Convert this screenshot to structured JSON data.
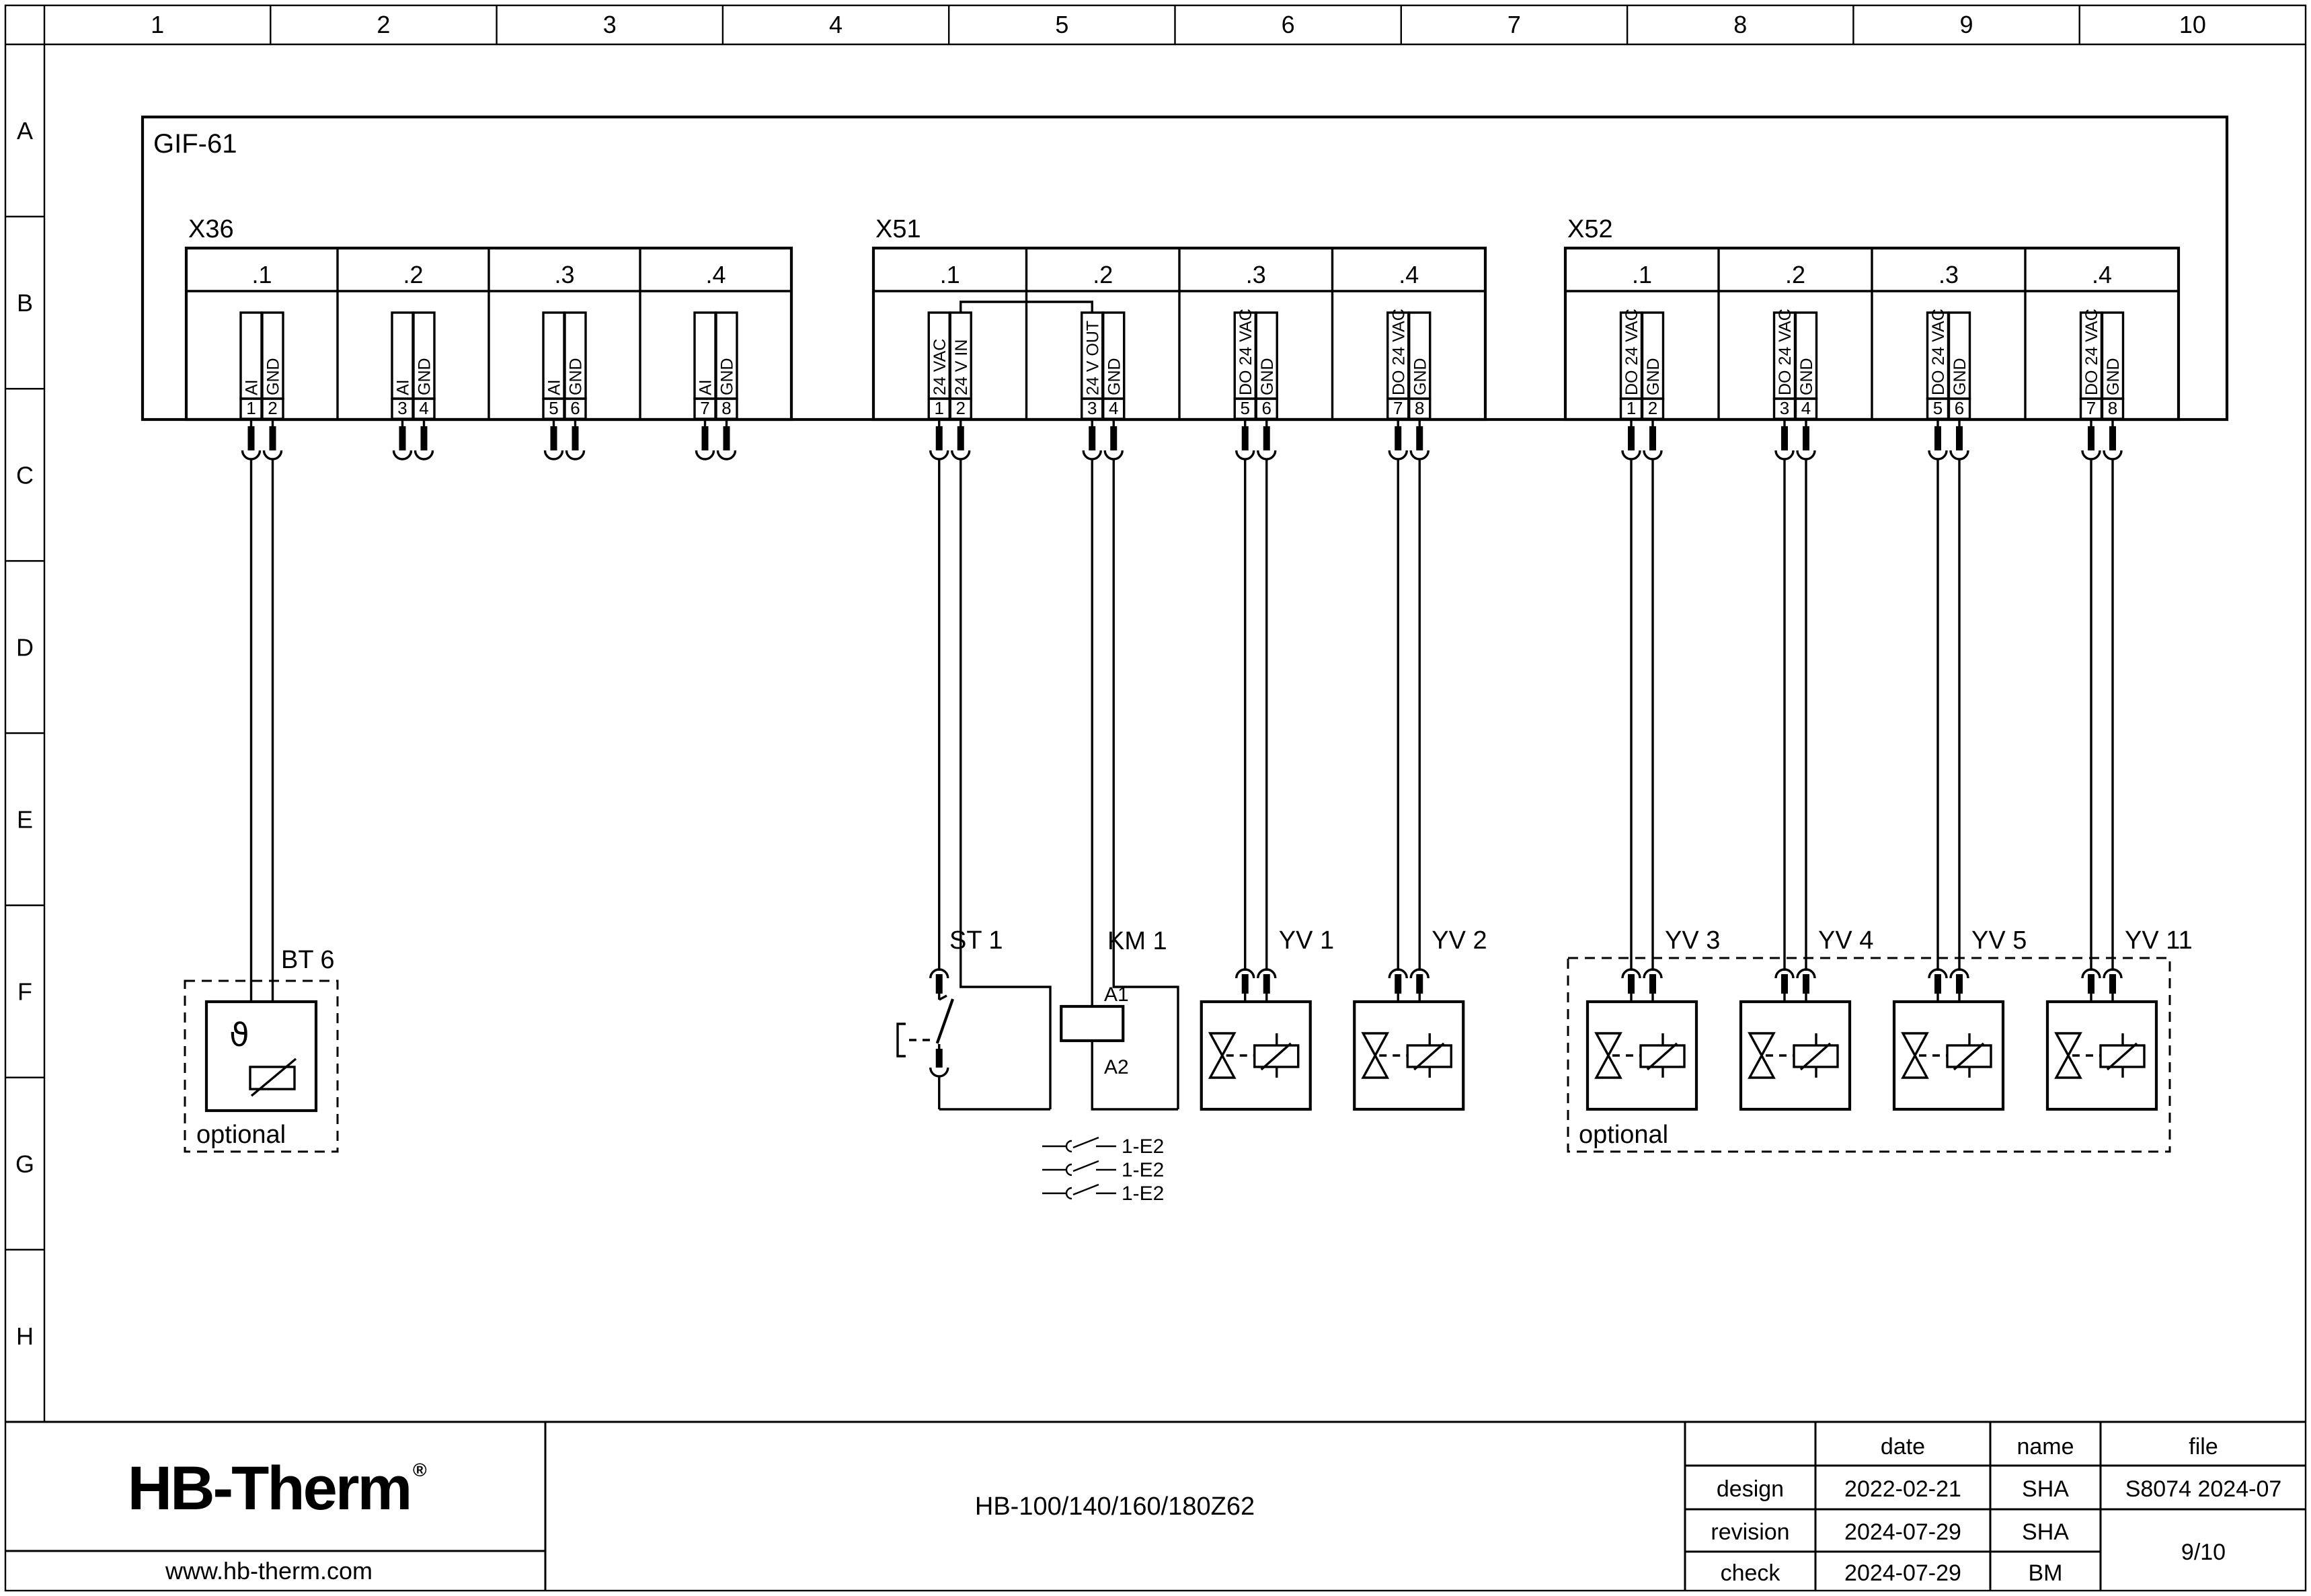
{
  "page": {
    "columns": [
      "1",
      "2",
      "3",
      "4",
      "5",
      "6",
      "7",
      "8",
      "9",
      "10"
    ],
    "rows": [
      "A",
      "B",
      "C",
      "D",
      "E",
      "F",
      "G",
      "H"
    ]
  },
  "module": {
    "label": "GIF-61"
  },
  "connectors": [
    {
      "label": "X36",
      "sections": [
        ".1",
        ".2",
        ".3",
        ".4"
      ],
      "pins": [
        {
          "n": "1",
          "label": "AI"
        },
        {
          "n": "2",
          "label": "GND"
        },
        {
          "n": "3",
          "label": "AI"
        },
        {
          "n": "4",
          "label": "GND"
        },
        {
          "n": "5",
          "label": "AI"
        },
        {
          "n": "6",
          "label": "GND"
        },
        {
          "n": "7",
          "label": "AI"
        },
        {
          "n": "8",
          "label": "GND"
        }
      ]
    },
    {
      "label": "X51",
      "sections": [
        ".1",
        ".2",
        ".3",
        ".4"
      ],
      "pins": [
        {
          "n": "1",
          "label": "24 VAC"
        },
        {
          "n": "2",
          "label": "24 V IN"
        },
        {
          "n": "3",
          "label": "24 V OUT"
        },
        {
          "n": "4",
          "label": "GND"
        },
        {
          "n": "5",
          "label": "DO 24 VAC"
        },
        {
          "n": "6",
          "label": "GND"
        },
        {
          "n": "7",
          "label": "DO 24 VAC"
        },
        {
          "n": "8",
          "label": "GND"
        }
      ]
    },
    {
      "label": "X52",
      "sections": [
        ".1",
        ".2",
        ".3",
        ".4"
      ],
      "pins": [
        {
          "n": "1",
          "label": "DO 24 VAC"
        },
        {
          "n": "2",
          "label": "GND"
        },
        {
          "n": "3",
          "label": "DO 24 VAC"
        },
        {
          "n": "4",
          "label": "GND"
        },
        {
          "n": "5",
          "label": "DO 24 VAC"
        },
        {
          "n": "6",
          "label": "GND"
        },
        {
          "n": "7",
          "label": "DO 24 VAC"
        },
        {
          "n": "8",
          "label": "GND"
        }
      ]
    }
  ],
  "devices": {
    "bt6": {
      "label": "BT 6",
      "theta": "ϑ",
      "optional": "optional"
    },
    "st1": {
      "label": "ST 1"
    },
    "km1": {
      "label": "KM 1",
      "a1": "A1",
      "a2": "A2"
    },
    "valves": [
      {
        "label": "YV 1"
      },
      {
        "label": "YV 2"
      },
      {
        "label": "YV 3"
      },
      {
        "label": "YV 4"
      },
      {
        "label": "YV 5"
      },
      {
        "label": "YV 11"
      }
    ],
    "optional_group_label": "optional",
    "contact_refs": [
      "1-E2",
      "1-E2",
      "1-E2"
    ]
  },
  "titleblock": {
    "logo": "HB-Therm",
    "logo_reg": "®",
    "website": "www.hb-therm.com",
    "model": "HB-100/140/160/180Z62",
    "colors": {
      "logo_navy": "#1c2b55"
    },
    "table": {
      "headers": [
        "date",
        "name",
        "file"
      ],
      "rows": [
        {
          "label": "design",
          "date": "2022-02-21",
          "name": "SHA",
          "file": "S8074 2024-07"
        },
        {
          "label": "revision",
          "date": "2024-07-29",
          "name": "SHA"
        },
        {
          "label": "check",
          "date": "2024-07-29",
          "name": "BM"
        }
      ],
      "page": "9/10"
    }
  }
}
